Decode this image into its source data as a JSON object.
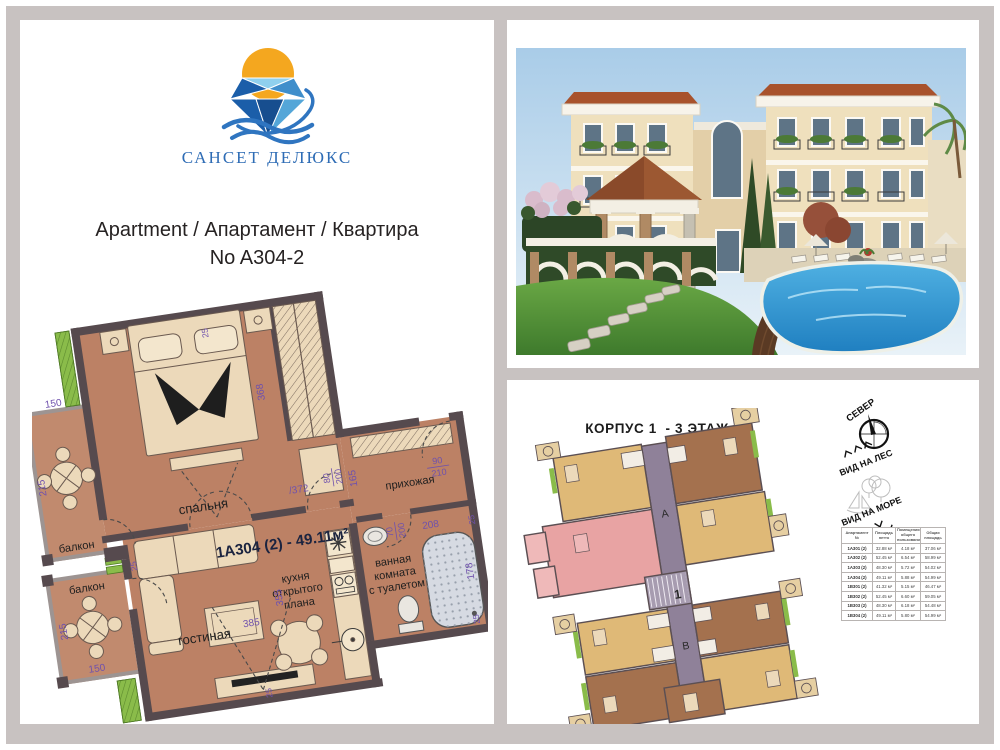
{
  "brand": {
    "name": "САНСЕТ ДЕЛЮКС",
    "sun_color": "#f4a71f",
    "blue": "#2e6cb5"
  },
  "heading": {
    "line1": "Apartment / Апартамент / Квартира",
    "line2": "No A304-2"
  },
  "floorplan": {
    "unit_label": "1A304 (2) - 49.11м²",
    "rooms": {
      "bedroom": "спальня",
      "balcony": "балкон",
      "living": "гостиная",
      "kitchen1": "кухня",
      "kitchen2": "открытого",
      "kitchen3": "плана",
      "hall": "прихожая",
      "bath1": "ванная",
      "bath2": "комната",
      "bath3": "с туалетом"
    },
    "dims": {
      "d150": "150",
      "d215": "215",
      "d368": "368",
      "d372": "/372",
      "d355": "355",
      "d385": "385",
      "d165": "165",
      "d208": "208",
      "d178": "178",
      "d25": "25",
      "d90": "90",
      "d210": "210",
      "d80": "80",
      "d200": "200",
      "d70": "70"
    },
    "colors": {
      "floor": "#bc8165",
      "wall": "#564a4e",
      "furniture": "#ecd9ba",
      "plants": "#8abc4a",
      "dims": "#6f51ad"
    }
  },
  "site": {
    "title1": "КОРПУС 1  - 3 ЭТАЖ",
    "title2": "ВАРИАНТ - 2",
    "compass_label": "СЕВЕР",
    "view_forest": "ВИД НА ЛЕС",
    "view_sea": "ВИД НА МОРЕ",
    "section_a": "А",
    "section_b": "В",
    "stair": "1",
    "highlight_color": "#e8a3a3",
    "table": {
      "headers": [
        "Апартамент №",
        "Площадь нетто",
        "Помещения общего пользования",
        "Общая площадь"
      ],
      "rows": [
        [
          "1A301 (2)",
          "32.88 м²",
          "4.18 м²",
          "37.06 м²"
        ],
        [
          "1A302 (2)",
          "52.45 м²",
          "6.54 м²",
          "58.99 м²"
        ],
        [
          "1A303 (2)",
          "48.30 м²",
          "5.72 м²",
          "54.02 м²"
        ],
        [
          "1A304 (2)",
          "49.11 м²",
          "5.88 м²",
          "54.99 м²"
        ],
        [
          "1B301 (2)",
          "41.32 м²",
          "5.15 м²",
          "46.47 м²"
        ],
        [
          "1B302 (2)",
          "52.45 м²",
          "6.60 м²",
          "59.05 м²"
        ],
        [
          "1B303 (2)",
          "48.30 м²",
          "6.18 м²",
          "54.48 м²"
        ],
        [
          "1B304 (2)",
          "49.11 м²",
          "5.80 м²",
          "54.99 м²"
        ]
      ]
    }
  }
}
